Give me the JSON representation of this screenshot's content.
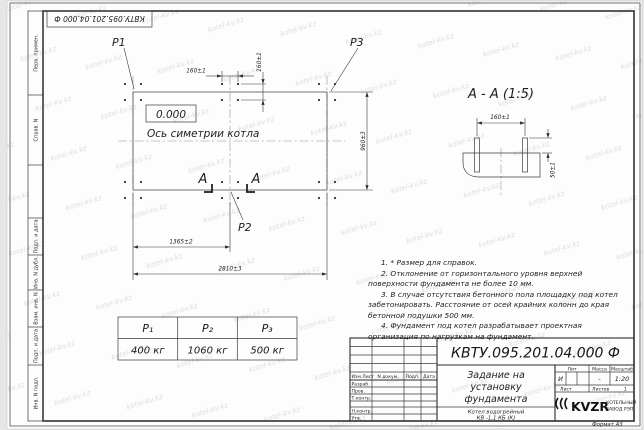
{
  "watermark": {
    "text": "kotel-kv.kz"
  },
  "colors": {
    "ink": "#2c2c2c",
    "watermark": "#dcdcdc",
    "paper": "#fdfdfd"
  },
  "stamp_top": {
    "text": "КВТУ.095.201.04.000 Ф"
  },
  "margin": {
    "labels": [
      "Перв. примен.",
      "Справ. N",
      "Подп. и дата",
      "Инв. N дубл.",
      "Взам. инв. N",
      "Подп. и дата",
      "Инв. N подл."
    ]
  },
  "plan": {
    "p1": "P1",
    "p2": "P2",
    "p3": "P3",
    "level": "0.000",
    "axis_label": "Ось симетрии котла",
    "section_letter_left": "А",
    "section_letter_right": "А",
    "dims": {
      "bolt_h": "160±1",
      "bolt_v": "160±1",
      "height": "960±3",
      "mid": "1365±2",
      "total": "2810±3"
    }
  },
  "detail": {
    "title": "А - А (1:5)",
    "dim_top": "160±1",
    "dim_side": "50±1"
  },
  "notes": [
    "1. * Размер для справок.",
    "2. Отклонение от горизонтального уровня верхней поверхности фундамента не более 10 мм.",
    "3. В случае отсутствия бетонного пола площадку под котел забетонировать. Расстояние от осей крайних колонн до края бетонной подушки 500 мм.",
    "4. Фундамент под котел разрабатывает проектная организация по нагрузкам на фундамент."
  ],
  "load_table": {
    "headers": [
      "P₁",
      "P₂",
      "P₃"
    ],
    "values": [
      "400 кг",
      "1060 кг",
      "500 кг"
    ]
  },
  "title_block": {
    "doc_number": "КВТУ.095.201.04.000 Ф",
    "title_line1": "Задание на",
    "title_line2": "установку",
    "title_line3": "фундамента",
    "product_line1": "Котел водогрейный",
    "product_line2": "КВ -1,1 КБ (К)",
    "col_izm": "Изм.Лист",
    "col_doc": "N докум.",
    "col_sign": "Подп.",
    "col_date": "Дата",
    "row_developed": "Разраб.",
    "row_checked": "Пров.",
    "row_tcontrol": "Т.контр.",
    "row_ncontrol": "Н.контр.",
    "row_approved": "Утв.",
    "lit_label": "Лит",
    "mass_label": "Масса",
    "scale_label": "Масштаб",
    "lit_value": "И",
    "mass_value": "-",
    "scale_value": "1:20",
    "sheet_label": "Лист",
    "sheets_label": "Листов",
    "sheets_value": "1",
    "logo_text": "KVZR",
    "logo_sub1": "КОТЕЛЬНЫЙ",
    "logo_sub2": "ЗАВОД РЭП",
    "format_note": "Формат А3"
  }
}
